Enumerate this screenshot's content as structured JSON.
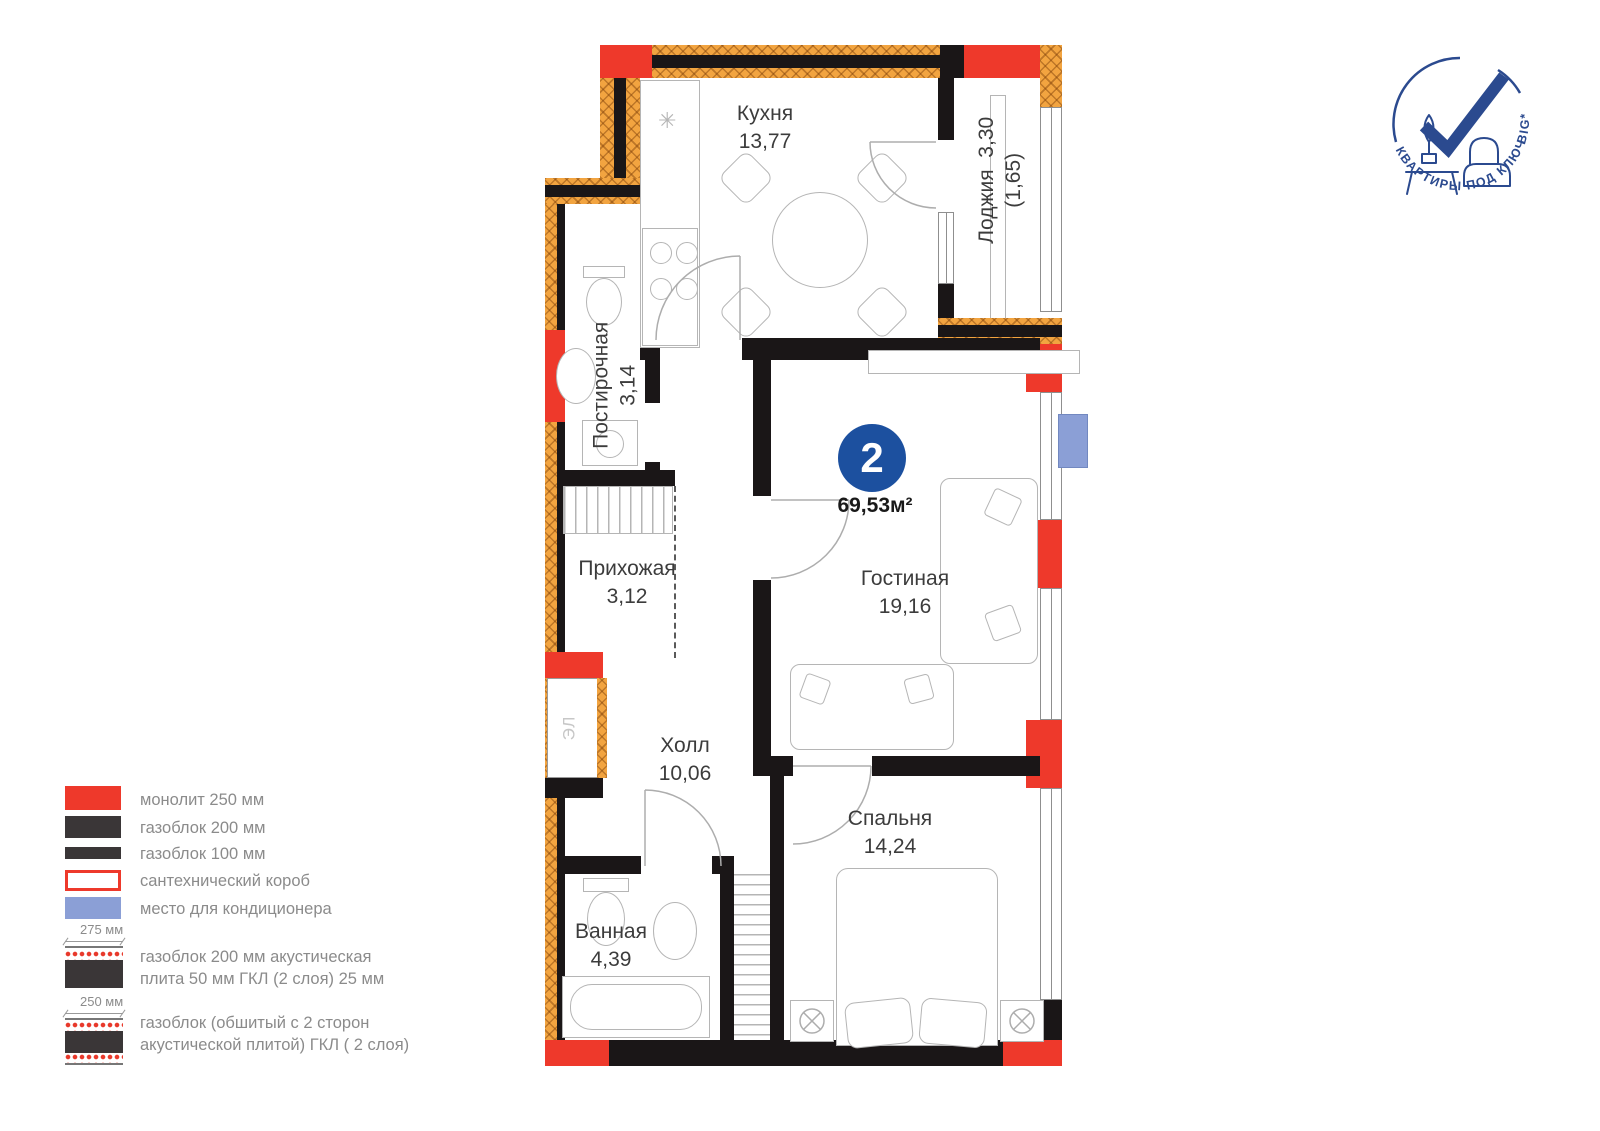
{
  "unit": {
    "rooms_count": "2",
    "total_area": "69,53м²"
  },
  "logo": {
    "arc_text": "КВАРТИРЫ ПОД КЛЮЧ",
    "brand": "BIG*"
  },
  "rooms": {
    "kitchen": {
      "name": "Кухня",
      "area": "13,77"
    },
    "loggia": {
      "name": "Лоджия",
      "area": "3,30",
      "area_reduced": "(1,65)"
    },
    "laundry": {
      "name": "Постирочная",
      "area": "3,14"
    },
    "entry": {
      "name": "Прихожая",
      "area": "3,12"
    },
    "living": {
      "name": "Гостиная",
      "area": "19,16"
    },
    "hall": {
      "name": "Холл",
      "area": "10,06"
    },
    "bedroom": {
      "name": "Спальня",
      "area": "14,24"
    },
    "bath": {
      "name": "Ванная",
      "area": "4,39"
    }
  },
  "shaft": {
    "label": "ЭЛ"
  },
  "legend": {
    "items": [
      {
        "label": "монолит 250 мм"
      },
      {
        "label": "газоблок 200 мм"
      },
      {
        "label": "газоблок 100 мм"
      },
      {
        "label": "сантехнический короб"
      },
      {
        "label": "место для кондиционера"
      }
    ],
    "layered": [
      {
        "dim": "275 мм",
        "label": "газоблок 200 мм акустическая плита 50 мм ГКЛ (2 слоя) 25 мм"
      },
      {
        "dim": "250 мм",
        "label": "газоблок (обшитый с 2 сторон акустической плитой) ГКЛ ( 2 слоя)"
      }
    ]
  },
  "colors": {
    "monolith_red": "#ee392b",
    "wall_black": "#1a1617",
    "hatch_orange": "#f2a440",
    "ac_blue": "#8b9fd6",
    "badge_blue": "#1c509f",
    "logo_blue": "#2b4a8f"
  }
}
